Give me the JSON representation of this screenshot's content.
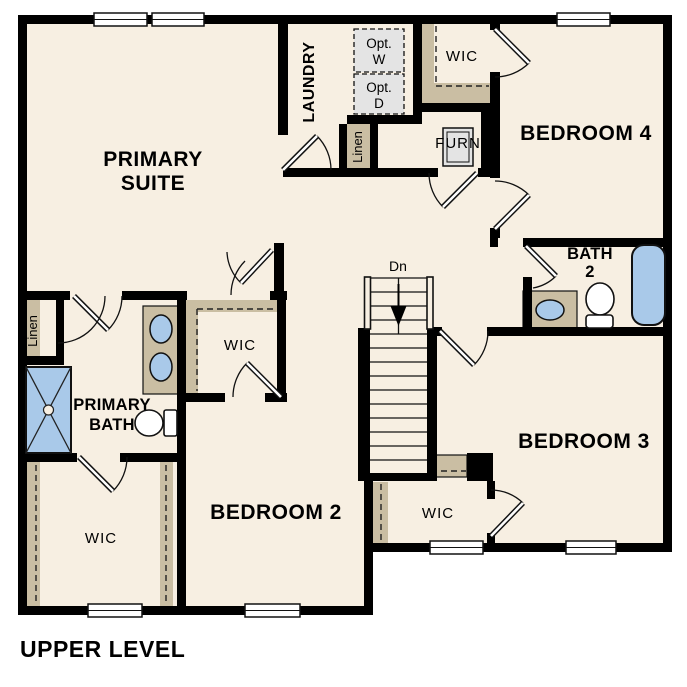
{
  "title": "UPPER LEVEL",
  "colors": {
    "background": "#ffffff",
    "room_fill": "#f7efe2",
    "wall": "#000000",
    "shelf_tan": "#cabea3",
    "fixture_blue": "#a9c9e9",
    "appliance_gray": "#e4e4e4",
    "text": "#000000"
  },
  "rooms": {
    "primary_suite": {
      "line1": "PRIMARY",
      "line2": "SUITE"
    },
    "laundry": {
      "label": "LAUNDRY"
    },
    "opt_washer": {
      "line1": "Opt.",
      "line2": "W"
    },
    "opt_dryer": {
      "line1": "Opt.",
      "line2": "D"
    },
    "wic_bedroom4": {
      "label": "WIC"
    },
    "bedroom4": {
      "label": "BEDROOM 4"
    },
    "linen_hall": {
      "label": "Linen"
    },
    "furnace": {
      "label": "FURN"
    },
    "bath2": {
      "line1": "BATH",
      "line2": "2"
    },
    "stairs": {
      "label": "Dn"
    },
    "linen_primary": {
      "label": "Linen"
    },
    "primary_bath": {
      "line1": "PRIMARY",
      "line2": "BATH"
    },
    "wic_primary_hall": {
      "label": "WIC"
    },
    "wic_primary": {
      "label": "WIC"
    },
    "bedroom2": {
      "label": "BEDROOM 2"
    },
    "wic_bedroom3": {
      "label": "WIC"
    },
    "bedroom3": {
      "label": "BEDROOM 3"
    }
  }
}
